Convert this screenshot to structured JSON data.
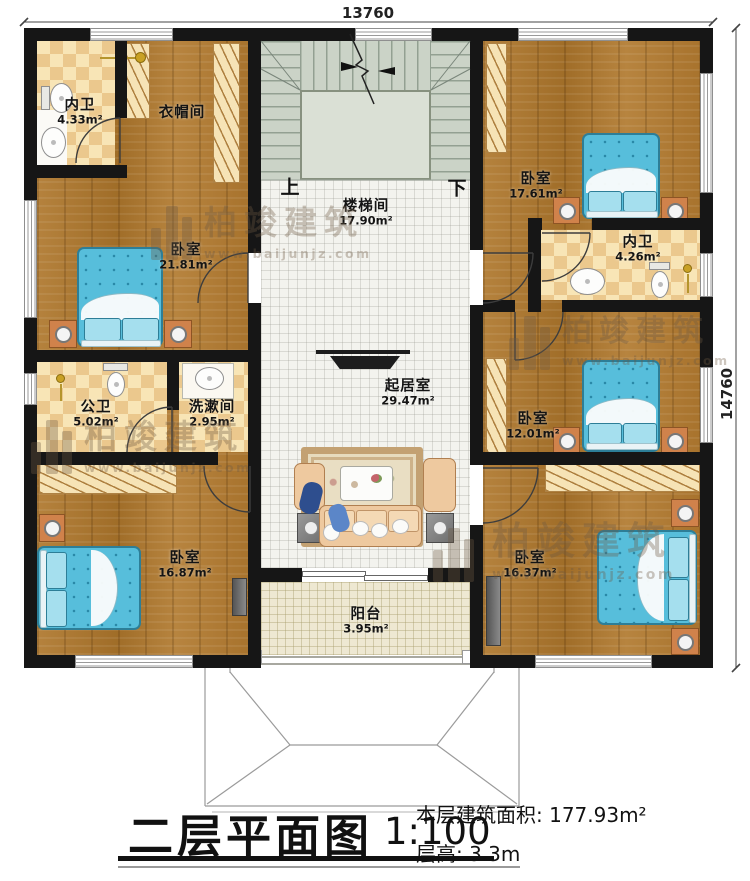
{
  "dimensions": {
    "width_mm": "13760",
    "height_mm": "14760"
  },
  "stairs": {
    "up": "上",
    "down": "下"
  },
  "rooms": [
    {
      "name": "内卫",
      "area": "4.33m²"
    },
    {
      "name": "衣帽间",
      "area": ""
    },
    {
      "name": "卧室",
      "area": "21.81m²"
    },
    {
      "name": "楼梯间",
      "area": "17.90m²"
    },
    {
      "name": "卧室",
      "area": "17.61m²"
    },
    {
      "name": "内卫",
      "area": "4.26m²"
    },
    {
      "name": "公卫",
      "area": "5.02m²"
    },
    {
      "name": "洗漱间",
      "area": "2.95m²"
    },
    {
      "name": "起居室",
      "area": "29.47m²"
    },
    {
      "name": "卧室",
      "area": "12.01m²"
    },
    {
      "name": "卧室",
      "area": "16.87m²"
    },
    {
      "name": "卧室",
      "area": "16.37m²"
    },
    {
      "name": "阳台",
      "area": "3.95m²"
    }
  ],
  "title_block": {
    "title": "二层平面图",
    "scale": "1:100",
    "floor_area": "本层建筑面积: 177.93m²",
    "floor_height": "层高: 3.3m"
  },
  "watermark": {
    "brand": "柏竣建筑",
    "url": "www.baijunjz.com"
  },
  "colors": {
    "wall": "#161616",
    "wood": "#ac7832",
    "bed": "#57bedb",
    "checker": "#f6e2b0"
  }
}
